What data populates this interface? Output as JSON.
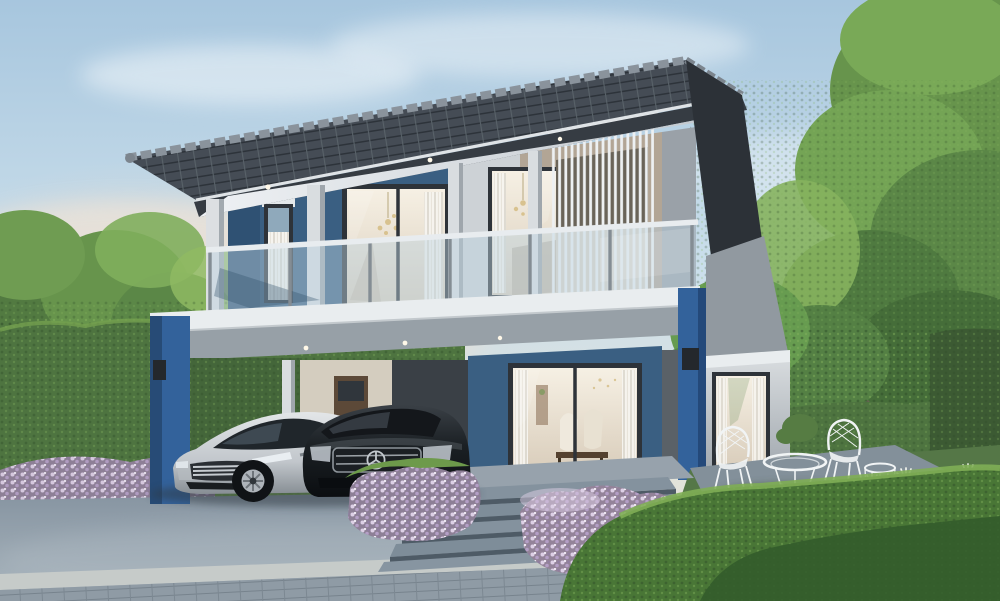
{
  "meta": {
    "scene_type": "architectural exterior rendering",
    "subject": "modern two-storey house at dusk with carport, two cars and landscaped garden"
  },
  "palette": {
    "sky_top": "#a7c6de",
    "sky_mid": "#cbdfeb",
    "sky_horizon": "#e8e3d7",
    "warm_glow": "#eed9c3",
    "cloud_white": "#f7fafc",
    "tree_green_dark": "#42663a",
    "tree_green": "#67944c",
    "tree_green_light": "#90ba63",
    "hedge_dark": "#3c5a33",
    "hedge_green": "#4e7440",
    "hedge_light": "#74a04f",
    "grass": "#5a7c47",
    "roof_tile": "#454c55",
    "roof_gable": "#2c3137",
    "ridge_cap": "#8a939c",
    "fascia_dark": "#363c43",
    "soffit_white": "#e8ecef",
    "wall_blue": "#3a5f82",
    "wall_blue_dark": "#2f5173",
    "pillar_blue": "#33629b",
    "wall_beige": "#b2a595",
    "wall_gray": "#9aa1a8",
    "wall_light": "#d3d7da",
    "corner_gray": "#5a6167",
    "frame_dark": "#2e3339",
    "glass_sky": "#a9c1d2",
    "glass_balcony": "#bfd4e2",
    "interior_warm": "#f2eadd",
    "curtain_white": "#f6f4ef",
    "door_wood": "#5c4938",
    "slab_white": "#e9edef",
    "beam_gray": "#97a0a7",
    "driveway": "#8d9aa6",
    "paver": "#8f9ba5",
    "curb": "#c6cbc9",
    "step_tread": "#7e8d99",
    "step_riser": "#4e5b66",
    "bloom_purple": "#c0abd1",
    "bloom_purple_light": "#ddd0e6",
    "flower_white": "#f3f6ee",
    "terrace_stone": "#83909a",
    "car_silver": "#ccd1d5",
    "car_black": "#15191d",
    "wheel_dark": "#101316",
    "rim_silver": "#aeb4ba",
    "furniture_white": "#f1f4f5",
    "sconce_dark": "#24282c"
  },
  "scene": {
    "elements": [
      "sky with soft clouds and warm dusk glow",
      "trees left and right",
      "tall boundary hedge",
      "two-storey modern house, blue and grey facade",
      "dark tiled mono-pitch roof with ridge caps",
      "second-floor balcony with glass railing",
      "vertical louvre screen on upper right window",
      "carport with silver sports car and black sedan",
      "ground-floor glass sliding doors with lit interior",
      "single-storey side extension",
      "entrance steps flanked by purple flowering shrubs",
      "garden terrace with white wire furniture",
      "white spider-lily flower bed",
      "concrete driveway and paved walkway"
    ]
  }
}
